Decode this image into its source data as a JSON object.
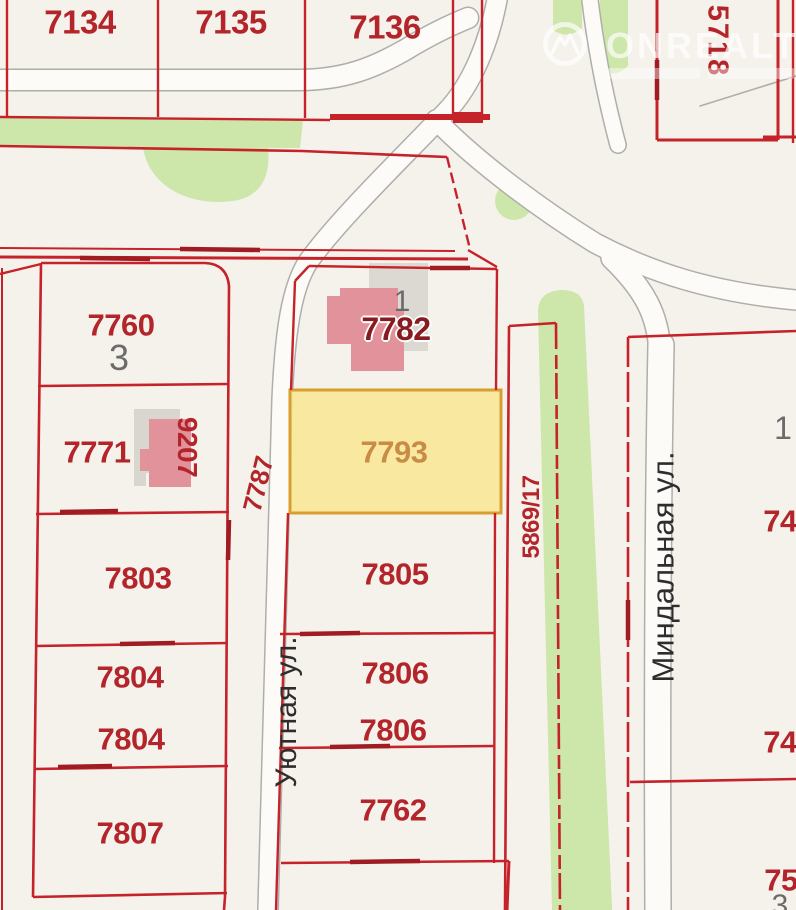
{
  "title": "Cadastral map fragment",
  "watermark": {
    "brand": "ONREALT"
  },
  "highlight": {
    "parcel": "7793",
    "fill": "#f7e79a",
    "border": "#d89e2e",
    "label_color": "#c98c46"
  },
  "colors": {
    "background": "#f5f2ec",
    "parcel_border": "#c5222a",
    "parcel_label": "#b3252a",
    "greenery": "#cde7ab",
    "road_fill": "#fcfbf8",
    "road_casing": "#b0aeab",
    "building": "#e2929a",
    "building_shadow": "#dcd8d2",
    "street_label": "#2d2d2d"
  },
  "streets": {
    "uyutnaya": "Уютная ул.",
    "mindalnaya": "Миндальная ул."
  },
  "labels": {
    "p7134": "7134",
    "p7135": "7135",
    "p7136": "7136",
    "p5718": "5718",
    "p7760": "7760",
    "n3": "3",
    "p7771": "7771",
    "p9207": "9207",
    "p7787": "7787",
    "p7782": "7782",
    "n1_7782": "1",
    "p7793": "7793",
    "p7803": "7803",
    "p7804a": "7804",
    "p7804b": "7804",
    "p7807": "7807",
    "p7805": "7805",
    "p7806a": "7806",
    "p7806b": "7806",
    "p7762": "7762",
    "p5869": "5869/17",
    "n1_right": "1",
    "p74a": "74",
    "p74b": "74",
    "p75": "75",
    "n3_right": "3"
  }
}
